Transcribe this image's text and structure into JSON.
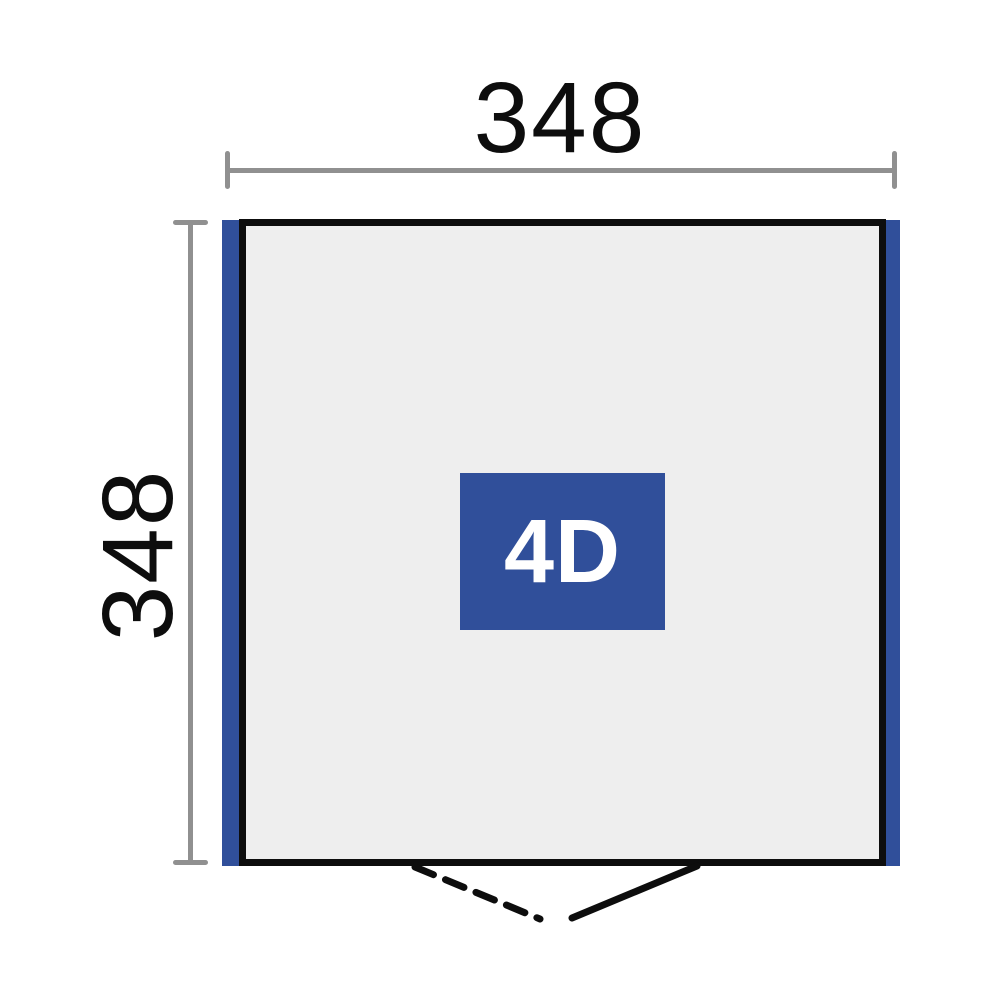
{
  "diagram": {
    "type": "shed-floor-plan",
    "model_label": "4D",
    "width_label": "348",
    "depth_label": "348",
    "door": {
      "left_leaf_style": "dashed-swing-line",
      "right_leaf_style": "solid-swing-line"
    },
    "colors": {
      "accent_blue": "#304f9a",
      "floor_fill": "#eeeeee",
      "outline_black": "#0d0d0d",
      "dimension_gray": "#909090",
      "model_text": "#ffffff",
      "background": "#ffffff"
    }
  }
}
